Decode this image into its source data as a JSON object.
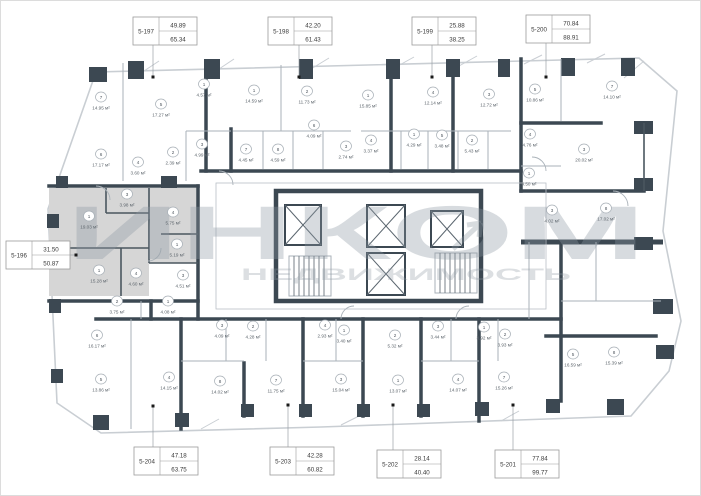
{
  "image": {
    "width": 701,
    "height": 496,
    "kind": "apartment floor plan"
  },
  "watermark": {
    "brand": "ИНКОМ",
    "subtitle": "НЕДВИЖИМОСТЬ"
  },
  "palette": {
    "wall_dark": "#3c4852",
    "line_light": "#aab2b9",
    "highlight_unit_fill": "#d6d6d6",
    "watermark_gray": "#8d98a2",
    "leader_dot": "#1a1a1a"
  },
  "highlighted_unit": "5-196",
  "area_unit_suffix": "м²",
  "callouts": [
    {
      "id": "5-196",
      "top": "31.50",
      "bottom": "50.87",
      "x": 5,
      "y": 240,
      "leader": {
        "x1": 69,
        "y1": 254,
        "x2": 75,
        "y2": 254
      },
      "dot": {
        "x": 75,
        "y": 254
      }
    },
    {
      "id": "5-197",
      "top": "49.89",
      "bottom": "65.34",
      "x": 132,
      "y": 16,
      "leader": {
        "x1": 152,
        "y1": 44,
        "x2": 152,
        "y2": 76
      },
      "dot": {
        "x": 152,
        "y": 76
      }
    },
    {
      "id": "5-198",
      "top": "42.20",
      "bottom": "61.43",
      "x": 267,
      "y": 16,
      "leader": {
        "x1": 298,
        "y1": 44,
        "x2": 298,
        "y2": 76
      },
      "dot": {
        "x": 298,
        "y": 76
      }
    },
    {
      "id": "5-199",
      "top": "25.88",
      "bottom": "38.25",
      "x": 411,
      "y": 16,
      "leader": {
        "x1": 431,
        "y1": 44,
        "x2": 431,
        "y2": 76
      },
      "dot": {
        "x": 431,
        "y": 76
      }
    },
    {
      "id": "5-200",
      "top": "70.84",
      "bottom": "88.91",
      "x": 525,
      "y": 14,
      "leader": {
        "x1": 545,
        "y1": 42,
        "x2": 545,
        "y2": 76
      },
      "dot": {
        "x": 545,
        "y": 76
      }
    },
    {
      "id": "5-201",
      "top": "77.84",
      "bottom": "99.77",
      "x": 494,
      "y": 449,
      "leader": {
        "x1": 512,
        "y1": 449,
        "x2": 512,
        "y2": 404
      },
      "dot": {
        "x": 512,
        "y": 404
      }
    },
    {
      "id": "5-202",
      "top": "28.14",
      "bottom": "40.40",
      "x": 376,
      "y": 449,
      "leader": {
        "x1": 392,
        "y1": 449,
        "x2": 392,
        "y2": 404
      },
      "dot": {
        "x": 392,
        "y": 404
      }
    },
    {
      "id": "5-203",
      "top": "42.28",
      "bottom": "60.82",
      "x": 269,
      "y": 446,
      "leader": {
        "x1": 287,
        "y1": 446,
        "x2": 287,
        "y2": 404
      },
      "dot": {
        "x": 287,
        "y": 404
      }
    },
    {
      "id": "5-204",
      "top": "47.18",
      "bottom": "63.75",
      "x": 133,
      "y": 446,
      "leader": {
        "x1": 152,
        "y1": 446,
        "x2": 152,
        "y2": 405
      },
      "dot": {
        "x": 152,
        "y": 405
      }
    }
  ],
  "rooms": [
    {
      "n": "7",
      "a": "14.95 м²",
      "x": 100,
      "y": 103
    },
    {
      "n": "5",
      "a": "17.27 м²",
      "x": 160,
      "y": 110
    },
    {
      "n": "1",
      "a": "4.57 м²",
      "x": 203,
      "y": 90
    },
    {
      "n": "6",
      "a": "17.17 м²",
      "x": 100,
      "y": 160
    },
    {
      "n": "4",
      "a": "3.60 м²",
      "x": 137,
      "y": 168
    },
    {
      "n": "2",
      "a": "2.39 м²",
      "x": 172,
      "y": 158
    },
    {
      "n": "3",
      "a": "4.99 м²",
      "x": 201,
      "y": 150
    },
    {
      "n": "1",
      "a": "14.59 м²",
      "x": 253,
      "y": 96
    },
    {
      "n": "2",
      "a": "11.73 м²",
      "x": 306,
      "y": 97
    },
    {
      "n": "6",
      "a": "4.09 м²",
      "x": 313,
      "y": 131
    },
    {
      "n": "7",
      "a": "4.45 м²",
      "x": 245,
      "y": 155
    },
    {
      "n": "8",
      "a": "4.59 м²",
      "x": 277,
      "y": 155
    },
    {
      "n": "3",
      "a": "2.74 м²",
      "x": 345,
      "y": 152
    },
    {
      "n": "1",
      "a": "15.85 м²",
      "x": 367,
      "y": 101
    },
    {
      "n": "4",
      "a": "12.14 м²",
      "x": 432,
      "y": 98
    },
    {
      "n": "3",
      "a": "12.72 м²",
      "x": 488,
      "y": 100
    },
    {
      "n": "4",
      "a": "3.37 м²",
      "x": 370,
      "y": 146
    },
    {
      "n": "1",
      "a": "4.29 м²",
      "x": 413,
      "y": 140
    },
    {
      "n": "5",
      "a": "3.48 м²",
      "x": 441,
      "y": 141
    },
    {
      "n": "2",
      "a": "5.43 м²",
      "x": 471,
      "y": 146
    },
    {
      "n": "5",
      "a": "10.86 м²",
      "x": 534,
      "y": 95
    },
    {
      "n": "7",
      "a": "14.10 м²",
      "x": 611,
      "y": 92
    },
    {
      "n": "4",
      "a": "4.76 м²",
      "x": 529,
      "y": 140
    },
    {
      "n": "3",
      "a": "20.02 м²",
      "x": 583,
      "y": 155
    },
    {
      "n": "1",
      "a": "4.50 м²",
      "x": 528,
      "y": 179
    },
    {
      "n": "3",
      "a": "4.02 м²",
      "x": 551,
      "y": 216
    },
    {
      "n": "8",
      "a": "17.02 м²",
      "x": 605,
      "y": 214
    },
    {
      "n": "5",
      "a": "16.59 м²",
      "x": 572,
      "y": 360
    },
    {
      "n": "8",
      "a": "15.39 м²",
      "x": 613,
      "y": 358
    },
    {
      "n": "7",
      "a": "15.26 м²",
      "x": 503,
      "y": 383
    },
    {
      "n": "2",
      "a": "3.93 м²",
      "x": 504,
      "y": 340
    },
    {
      "n": "1",
      "a": "3.92 м²",
      "x": 483,
      "y": 333
    },
    {
      "n": "1",
      "a": "13.07 м²",
      "x": 397,
      "y": 386
    },
    {
      "n": "4",
      "a": "14.07 м²",
      "x": 457,
      "y": 385
    },
    {
      "n": "2",
      "a": "5.32 м²",
      "x": 394,
      "y": 341
    },
    {
      "n": "3",
      "a": "3.44 м²",
      "x": 437,
      "y": 332
    },
    {
      "n": "8",
      "a": "14.02 м²",
      "x": 219,
      "y": 387
    },
    {
      "n": "7",
      "a": "11.75 м²",
      "x": 275,
      "y": 386
    },
    {
      "n": "3",
      "a": "15.04 м²",
      "x": 340,
      "y": 385
    },
    {
      "n": "3",
      "a": "4.09 м²",
      "x": 221,
      "y": 331
    },
    {
      "n": "2",
      "a": "4.28 м²",
      "x": 252,
      "y": 332
    },
    {
      "n": "4",
      "a": "2.93 м²",
      "x": 324,
      "y": 331
    },
    {
      "n": "1",
      "a": "3.40 м²",
      "x": 343,
      "y": 336
    },
    {
      "n": "5",
      "a": "13.86 м²",
      "x": 100,
      "y": 385
    },
    {
      "n": "6",
      "a": "16.17 м²",
      "x": 96,
      "y": 341
    },
    {
      "n": "4",
      "a": "14.15 м²",
      "x": 168,
      "y": 383
    },
    {
      "n": "2",
      "a": "3.75 м²",
      "x": 116,
      "y": 307
    },
    {
      "n": "1",
      "a": "4.08 м²",
      "x": 167,
      "y": 307
    },
    {
      "n": "3",
      "a": "3.98 м²",
      "x": 126,
      "y": 200
    },
    {
      "n": "1",
      "a": "19.03 м²",
      "x": 88,
      "y": 222
    },
    {
      "n": "4",
      "a": "5.75 м²",
      "x": 172,
      "y": 218
    },
    {
      "n": "1",
      "a": "5.19 м²",
      "x": 176,
      "y": 250
    },
    {
      "n": "1",
      "a": "15.28 м²",
      "x": 98,
      "y": 276
    },
    {
      "n": "4",
      "a": "4.60 м²",
      "x": 135,
      "y": 279
    },
    {
      "n": "3",
      "a": "4.51 м²",
      "x": 182,
      "y": 281
    }
  ]
}
